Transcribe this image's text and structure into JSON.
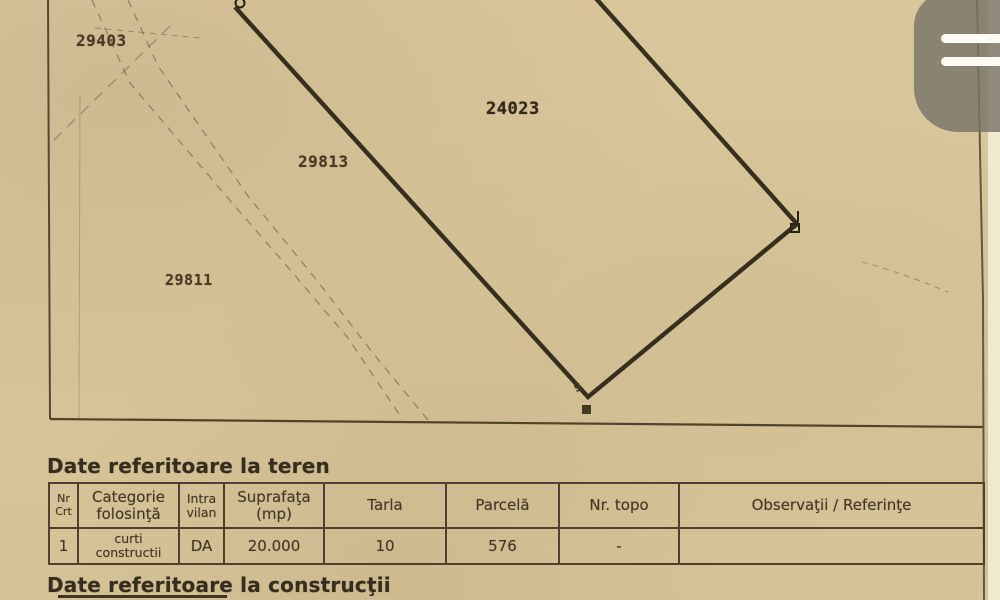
{
  "document_title": "Plan de amplasament cadastral (scan)",
  "map": {
    "neighbor_parcel_labels": [
      {
        "text": "29403"
      },
      {
        "text": "29813"
      },
      {
        "text": "29811"
      }
    ],
    "main_parcel_label": {
      "text": "24023"
    },
    "corner_point_label": {
      "text": "9"
    }
  },
  "teren": {
    "heading": "Date referitoare la teren",
    "table": {
      "headers": [
        {
          "line1": "Nr",
          "line2": "Crt"
        },
        {
          "line1": "Categorie",
          "line2": "folosinţă"
        },
        {
          "line1": "Intra",
          "line2": "vilan"
        },
        {
          "line1": "Suprafaţa",
          "line2": "(mp)"
        },
        {
          "line1": "Tarla"
        },
        {
          "line1": "Parcelă"
        },
        {
          "line1": "Nr. topo"
        },
        {
          "line1": "Observaţii / Referinţe"
        }
      ],
      "row": {
        "nr_crt": "1",
        "categorie_line1": "curti",
        "categorie_line2": "constructii",
        "intravilan": "DA",
        "suprafata": "20.000",
        "tarla": "10",
        "parcela": "576",
        "nr_topo": "-",
        "observatii": ""
      }
    }
  },
  "constructii": {
    "heading": "Date referitoare la construcţii"
  },
  "overlay": {
    "icon": "drag-handle-icon"
  },
  "colors": {
    "paper": "#d8c59a",
    "ink": "#3a2f1f",
    "table_border": "#4f4130",
    "bold_parcel_line": "#2a2214",
    "overlay_gray": "#7a7468",
    "page_edge_strip": "#f0e9d0"
  }
}
